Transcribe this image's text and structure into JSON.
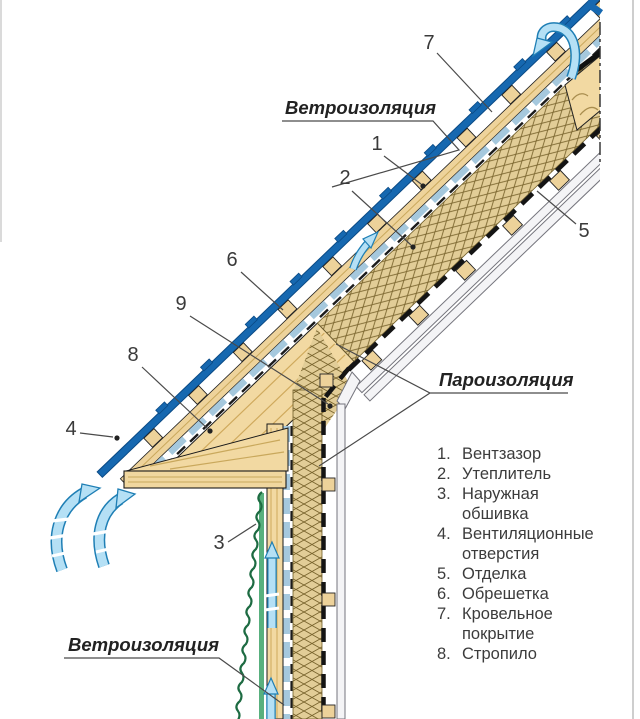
{
  "diagram": {
    "title": "Схема утепления кровли и стены (вентзазор)",
    "labels": {
      "wind_top": "Ветроизоляция",
      "wind_bottom": "Ветроизоляция",
      "vapor": "Пароизоляция"
    },
    "callouts": {
      "c1": "1",
      "c2": "2",
      "c3": "3",
      "c4": "4",
      "c5": "5",
      "c6": "6",
      "c7": "7",
      "c8": "8",
      "c9": "9"
    },
    "legend": {
      "items": [
        {
          "num": "1.",
          "text": "Вентзазор"
        },
        {
          "num": "2.",
          "text": "Утеплитель"
        },
        {
          "num": "3.",
          "text": "Наружная обшивка"
        },
        {
          "num": "4.",
          "text": "Вентиляционные отверстия"
        },
        {
          "num": "5.",
          "text": "Отделка"
        },
        {
          "num": "6.",
          "text": "Обрешетка"
        },
        {
          "num": "7.",
          "text": "Кровельное покрытие"
        },
        {
          "num": "8.",
          "text": "Стропило"
        }
      ]
    },
    "colors": {
      "roofing_blue": "#1668b0",
      "air_arrow_fill": "#b5e0f5",
      "air_arrow_edge": "#1f7fb5",
      "wood_tan": "#f2d9a2",
      "insulation_bg": "#e2cd97",
      "siding_green": "#3f9e68",
      "finishing_gray": "#f4f4f6",
      "wind_barrier_blue": "#a5c8dd"
    }
  }
}
